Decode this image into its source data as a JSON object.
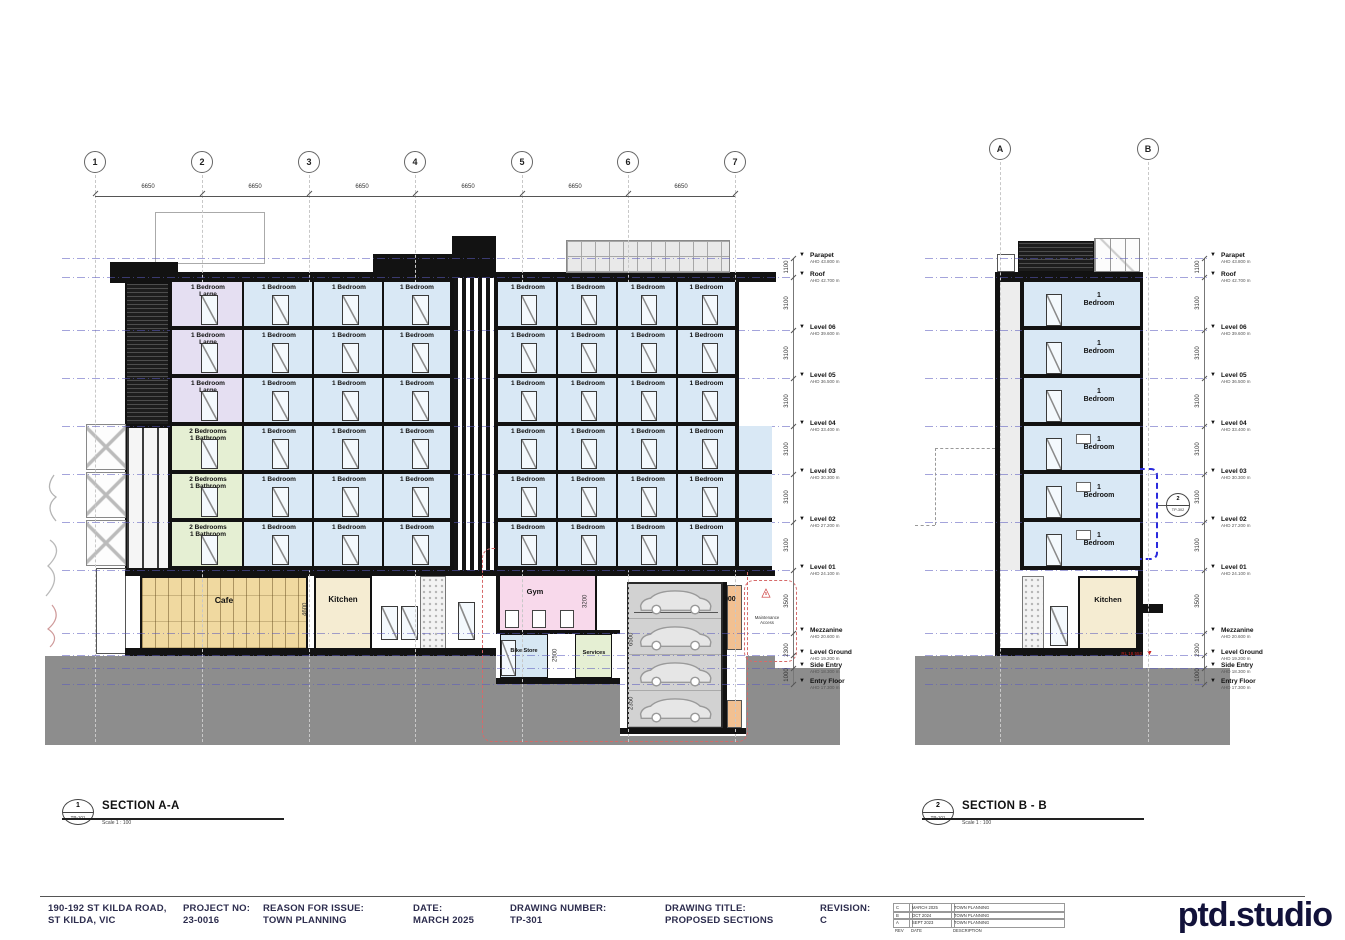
{
  "levels": [
    {
      "name": "Parapet",
      "ahd": "AHD 43.800 m"
    },
    {
      "name": "Roof",
      "ahd": "AHD 42.700 m"
    },
    {
      "name": "Level 06",
      "ahd": "AHD 39.600 m"
    },
    {
      "name": "Level 05",
      "ahd": "AHD 36.500 m"
    },
    {
      "name": "Level 04",
      "ahd": "AHD 33.400 m"
    },
    {
      "name": "Level 03",
      "ahd": "AHD 30.300 m"
    },
    {
      "name": "Level 02",
      "ahd": "AHD 27.200 m"
    },
    {
      "name": "Level 01",
      "ahd": "AHD 24.100 m"
    },
    {
      "name": "Mezzanine",
      "ahd": "AHD 20.600 m"
    },
    {
      "name": "Level Ground",
      "ahd": "AHD 19.200 m"
    },
    {
      "name": "Side Entry",
      "ahd": "AHD 18.300 m"
    },
    {
      "name": "Entry Floor",
      "ahd": "AHD 17.300 m"
    }
  ],
  "vertical_dims": [
    "1100",
    "3100",
    "3100",
    "3100",
    "3100",
    "3100",
    "3100",
    "3500",
    "2300",
    "1000"
  ],
  "sections": {
    "a": {
      "grid_bubbles": [
        "1",
        "2",
        "3",
        "4",
        "5",
        "6",
        "7"
      ],
      "grid_dims": [
        "6650",
        "6650",
        "6650",
        "6650",
        "6650",
        "6650"
      ],
      "left_rows": [
        [
          "1 Bedroom\nLarge",
          "1 Bedroom",
          "1 Bedroom",
          "1 Bedroom"
        ],
        [
          "1 Bedroom\nLarge",
          "1 Bedroom",
          "1 Bedroom",
          "1 Bedroom"
        ],
        [
          "1 Bedroom\nLarge",
          "1 Bedroom",
          "1 Bedroom",
          "1 Bedroom"
        ],
        [
          "2 Bedrooms\n1 Bathroom",
          "1 Bedroom",
          "1 Bedroom",
          "1 Bedroom"
        ],
        [
          "2 Bedrooms\n1 Bathroom",
          "1 Bedroom",
          "1 Bedroom",
          "1 Bedroom"
        ],
        [
          "2 Bedrooms\n1 Bathroom",
          "1 Bedroom",
          "1 Bedroom",
          "1 Bedroom"
        ]
      ],
      "right_rows": [
        [
          "1 Bedroom",
          "1 Bedroom",
          "1 Bedroom",
          "1 Bedroom"
        ],
        [
          "1 Bedroom",
          "1 Bedroom",
          "1 Bedroom",
          "1 Bedroom"
        ],
        [
          "1 Bedroom",
          "1 Bedroom",
          "1 Bedroom",
          "1 Bedroom"
        ],
        [
          "1 Bedroom",
          "1 Bedroom",
          "1 Bedroom",
          "1 Bedroom"
        ],
        [
          "1 Bedroom",
          "1 Bedroom",
          "1 Bedroom",
          "1 Bedroom"
        ],
        [
          "1 Bedroom",
          "1 Bedroom",
          "1 Bedroom",
          "1 Bedroom"
        ]
      ],
      "ground": {
        "cafe": "Cafe",
        "kitchen": "Kitchen",
        "gym": "Gym",
        "bike_store": "Bike Store",
        "services": "Services",
        "car_stacker": "Car Stacking\nSystem",
        "dim_cafe_kitchen": "4600",
        "dim_gym": "3200",
        "dim_bike": "2500",
        "dim_stacker_width": "6000",
        "dim_stacker_depth": "6500",
        "dim_pit": "2350",
        "dim_gap": "900",
        "maintenance_note": "Maintenance\nAccess",
        "revision_delta": "5"
      },
      "callout": {
        "number": "1",
        "sheet": "TP-101",
        "title": "SECTION A-A",
        "scale": "Scale   1 : 100"
      }
    },
    "b": {
      "grid_bubbles": [
        "A",
        "B"
      ],
      "rows": [
        "1\nBedroom",
        "1\nBedroom",
        "1\nBedroom",
        "1\nBedroom",
        "1\nBedroom",
        "1\nBedroom"
      ],
      "ground": {
        "kitchen": "Kitchen",
        "rl_note": "RL 18.552"
      },
      "detail_ref": {
        "number": "2",
        "sheet": "TP-302"
      },
      "callout": {
        "number": "2",
        "sheet": "TP-101",
        "title": "SECTION B - B",
        "scale": "Scale   1 : 100"
      }
    }
  },
  "title_block": {
    "address_line1": "190-192 ST KILDA ROAD,",
    "address_line2": "ST KILDA, VIC",
    "project_no_label": "PROJECT NO:",
    "project_no": "23-0016",
    "reason_label": "REASON FOR ISSUE:",
    "reason": "TOWN PLANNING",
    "date_label": "DATE:",
    "date": "MARCH 2025",
    "drawing_number_label": "DRAWING NUMBER:",
    "drawing_number": "TP-301",
    "drawing_title_label": "DRAWING TITLE:",
    "drawing_title": "PROPOSED SECTIONS",
    "revision_label": "REVISION:",
    "revision": "C",
    "revision_table": {
      "header": [
        "REV",
        "DATE",
        "DESCRIPTION"
      ],
      "rows": [
        [
          "C",
          "MARCH 2025",
          "TOWN PLANNING"
        ],
        [
          "B",
          "OCT 2024",
          "TOWN PLANNING"
        ],
        [
          "A",
          "SEPT 2023",
          "TOWN PLANNING"
        ]
      ]
    },
    "logo": "ptd.studio"
  }
}
